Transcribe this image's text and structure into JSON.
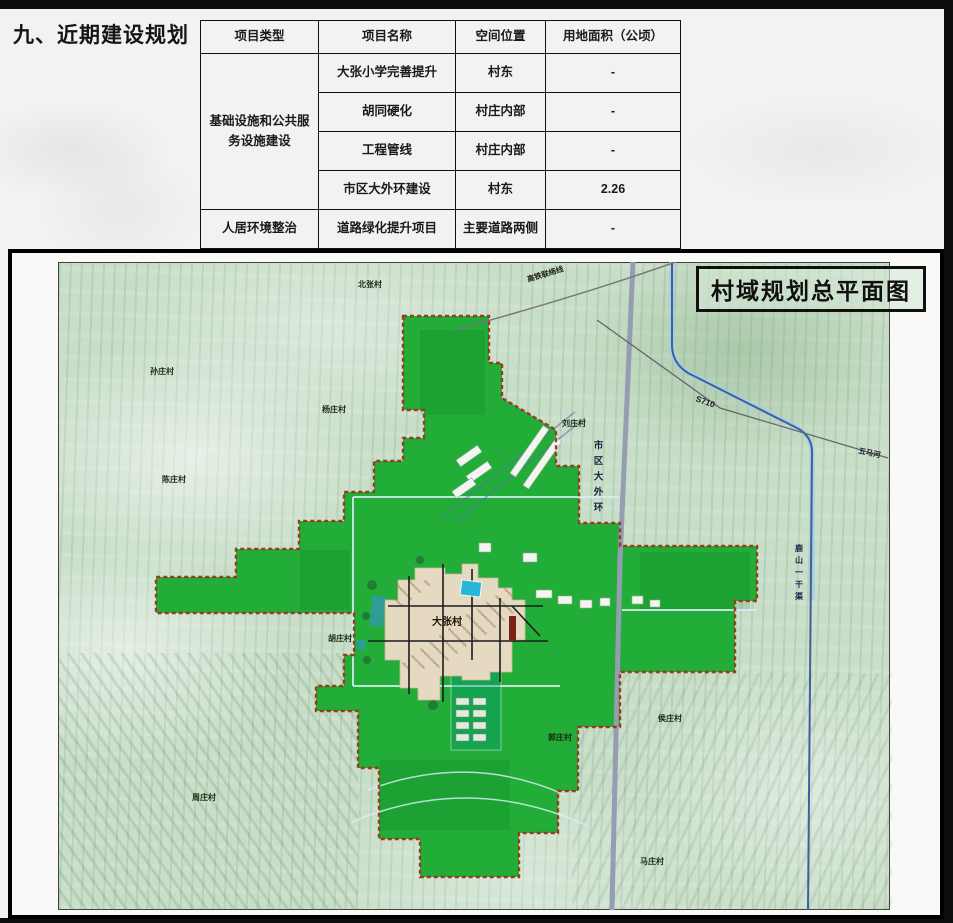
{
  "page": {
    "section_title": "九、近期建设规划"
  },
  "table": {
    "headers": [
      "项目类型",
      "项目名称",
      "空间位置",
      "用地面积（公顷）"
    ],
    "groups": [
      {
        "category": "基础设施和公共服务设施建设",
        "rows": [
          {
            "name": "大张小学完善提升",
            "location": "村东",
            "area": "-"
          },
          {
            "name": "胡同硬化",
            "location": "村庄内部",
            "area": "-"
          },
          {
            "name": "工程管线",
            "location": "村庄内部",
            "area": "-"
          },
          {
            "name": "市区大外环建设",
            "location": "村东",
            "area": "2.26"
          }
        ]
      },
      {
        "category": "人居环境整治",
        "rows": [
          {
            "name": "道路绿化提升项目",
            "location": "主要道路两侧",
            "area": "-"
          }
        ]
      }
    ]
  },
  "map": {
    "title": "村域规划总平面图",
    "center_label": "大张村",
    "ring_road_label": "市区大外环",
    "canal_label": "鹿山一干渠",
    "provincial_road_label": "S710",
    "river_label": "五马河",
    "railway_label": "高铁联络线",
    "village_labels": [
      {
        "text": "北张村"
      },
      {
        "text": "孙庄村"
      },
      {
        "text": "陈庄村"
      },
      {
        "text": "杨庄村"
      },
      {
        "text": "刘庄村"
      },
      {
        "text": "胡庄村"
      },
      {
        "text": "侯庄村"
      },
      {
        "text": "郭庄村"
      },
      {
        "text": "周庄村"
      },
      {
        "text": "马庄村"
      }
    ],
    "colors": {
      "plan_green": "#21ad38",
      "boundary_red": "#9c3a20",
      "village_tan": "#e6d9c2",
      "water_blue": "#3f6fae",
      "pond_cyan": "#29b5d8",
      "ring_road_gray": "#969cb2"
    }
  }
}
